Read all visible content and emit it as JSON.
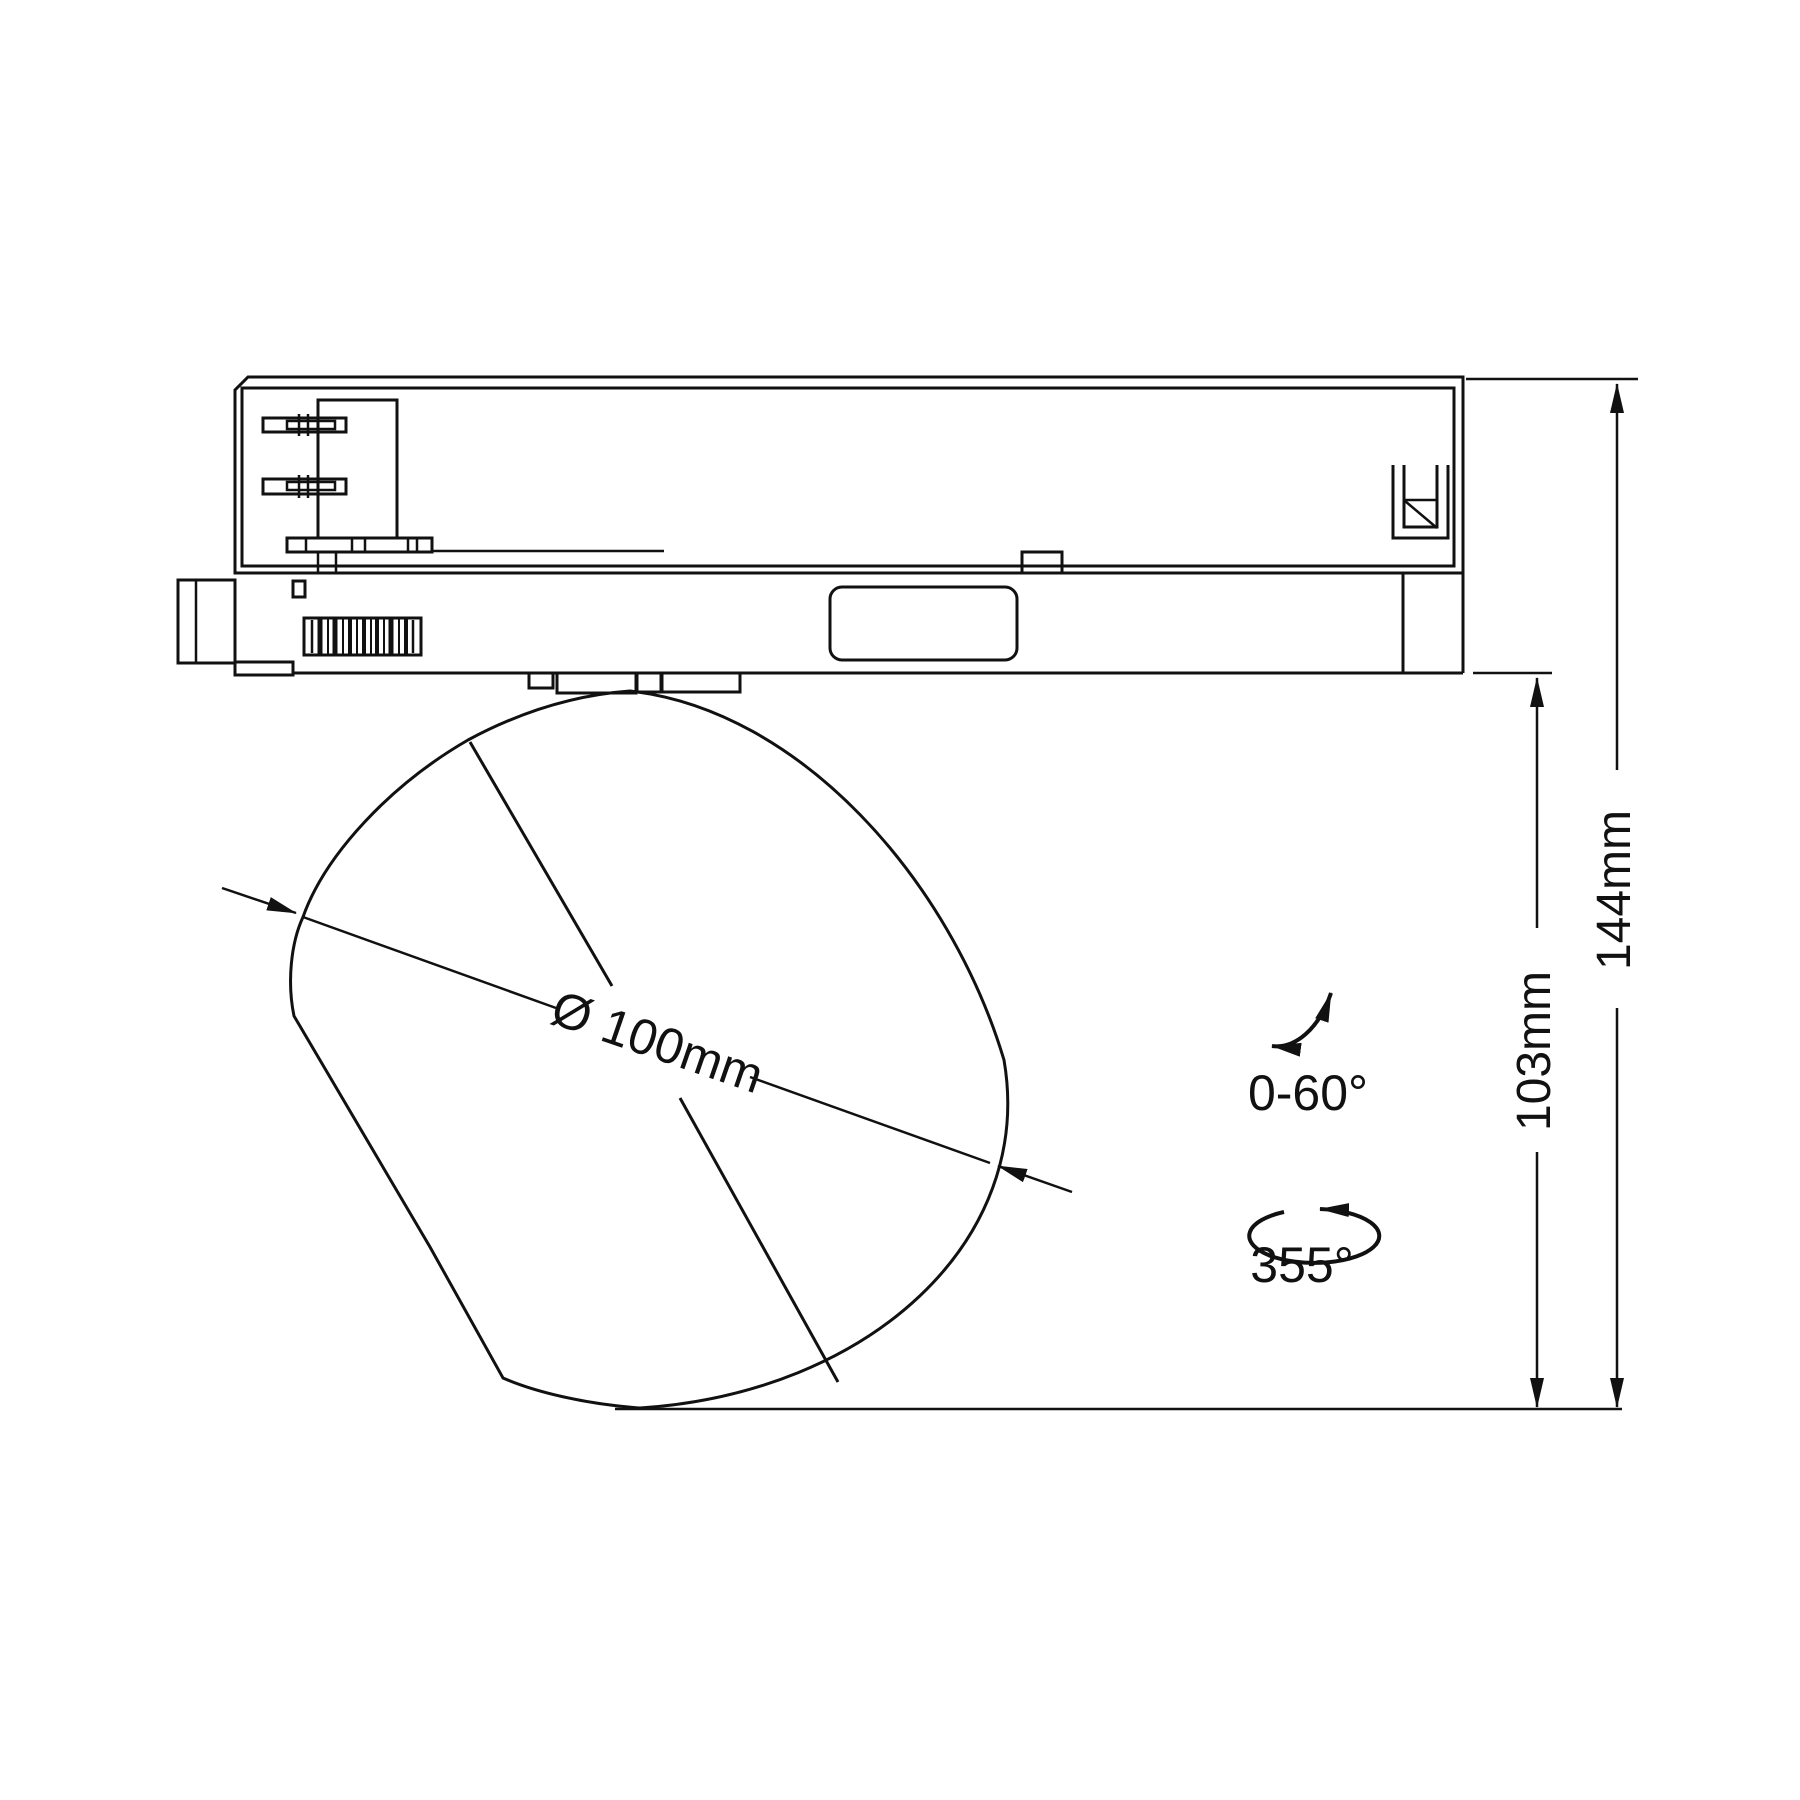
{
  "drawing": {
    "background": "#ffffff",
    "stroke_color": "#111111",
    "annotations": {
      "diameter_label": "Ø 100mm",
      "tilt_range_label": "0-60°",
      "swivel_range_label": "355°",
      "body_height_label": "103mm",
      "total_height_label": "144mm"
    }
  }
}
